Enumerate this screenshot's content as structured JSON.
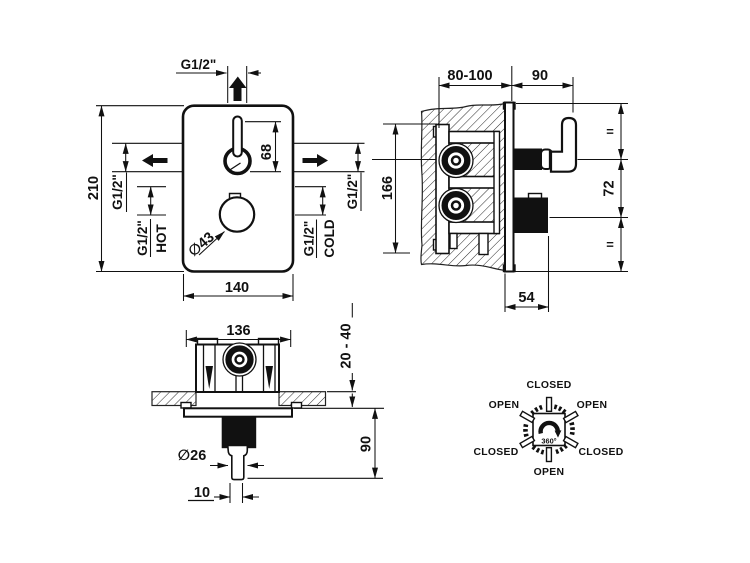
{
  "front": {
    "top_port": "G1/2\"",
    "height": "210",
    "width": "140",
    "lever_travel": "68",
    "knob_dia": "∅43",
    "left_port": "G1/2\"",
    "left_supply": "G1/2\"",
    "hot": "HOT",
    "right_port": "G1/2\"",
    "right_supply": "G1/2\"",
    "cold": "COLD"
  },
  "side": {
    "depth_range": "80-100",
    "handle_proj": "90",
    "height": "166",
    "spacing": "72",
    "eq_top": "=",
    "eq_bottom": "=",
    "knob_proj": "54"
  },
  "bottom": {
    "width": "136",
    "adjust_range": "20 - 40",
    "proj": "90",
    "spout_dia": "∅26",
    "tip_width": "10"
  },
  "dial": {
    "n": "CLOSED",
    "nw": "OPEN",
    "ne": "OPEN",
    "sw_label": "CLOSED",
    "se": "CLOSED",
    "s": "OPEN",
    "rotation": "360°"
  }
}
